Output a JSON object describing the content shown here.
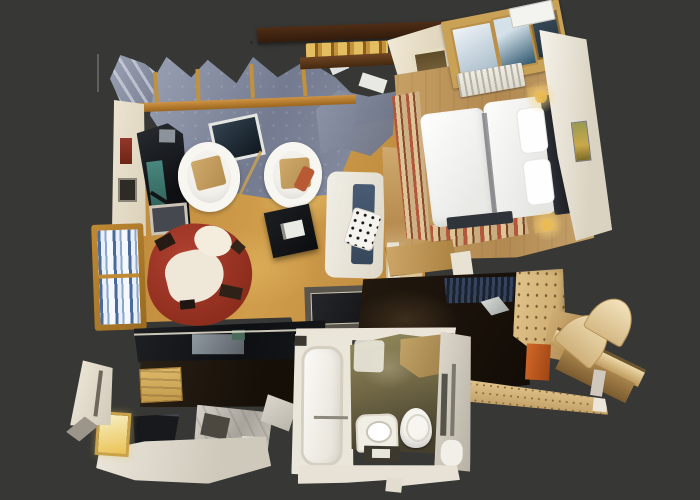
{
  "scene": {
    "kind": "3D dollhouse top-down scan of a small apartment",
    "background_color": "#373735",
    "visible_text": "none"
  },
  "palette": {
    "backdrop": "#373735",
    "living_floor_wood": "#c79040",
    "bedroom_floor_wood": "#c29a62",
    "walls_cream": "#eae3d2",
    "roof_scan_blue_grey": "#8b92a6",
    "mantel_beam_brown": "#46281a",
    "brass_lights": "#c2933a",
    "sofa_red": "#9e3424",
    "daybed_navy": "#475a72",
    "area_rug_dark": "#1e1f21",
    "hall_floor_dark": "#1b140c",
    "kitchen_counter_black": "#15171a",
    "plywood_wardrobe": "#d8bc84",
    "door_orange": "#c0571f",
    "bathroom_floor_olive": "#867c50",
    "runner_rug_red": "#b3573c",
    "lamp_glow": "#f8d584"
  },
  "rooms": [
    {
      "name": "Living room",
      "floor": "golden wood with sunlight pools",
      "furniture": [
        "bookshelf with books",
        "dark TV cabinet with teal screen",
        "white tub armchair with tan cushion",
        "second white tub armchair with red bag",
        "round red sofa draped with white throw",
        "black coffee table with open book",
        "white daybed with navy mattress and diamond-pattern cushion",
        "dark framed area rug",
        "timber loft railing with rungs",
        "wall pictures"
      ]
    },
    {
      "name": "Bedroom",
      "floor": "light wood planks",
      "furniture": [
        "double bed with two white duvets",
        "dark headboard",
        "two white pillows",
        "roof skylight windows",
        "white ribbed radiator",
        "red-striped runner rugs",
        "small framed wall picture",
        "two lit bedside lamps on wooden nightstands",
        "low wooden dresser"
      ]
    },
    {
      "name": "Kitchen",
      "floor": "dark wood walkway",
      "furniture": [
        "black countertop run with steel sink",
        "second black counter cabinet",
        "stone worktop block",
        "wooden stool",
        "white base cabinets",
        "small glowing window",
        "cream wall fragments"
      ]
    },
    {
      "name": "Bathroom",
      "floor": "olive stone shading to dark",
      "furniture": [
        "bathtub",
        "toilet",
        "washbasin unit",
        "shower tray",
        "mirror wall strips"
      ]
    },
    {
      "name": "Hallway",
      "floor": "near-black stone",
      "furniture": [
        "speckled plywood wardrobe",
        "orange door panel",
        "curved blond-wood bench and rail",
        "navy slatted mat",
        "light threshold object"
      ]
    }
  ],
  "architecture": [
    "dark timber mantel beam with brass lights",
    "cream chimney block with niche",
    "partially scanned grey-blue roof planes with skylight opening",
    "scan noise: thin pole and dots on backdrop"
  ]
}
